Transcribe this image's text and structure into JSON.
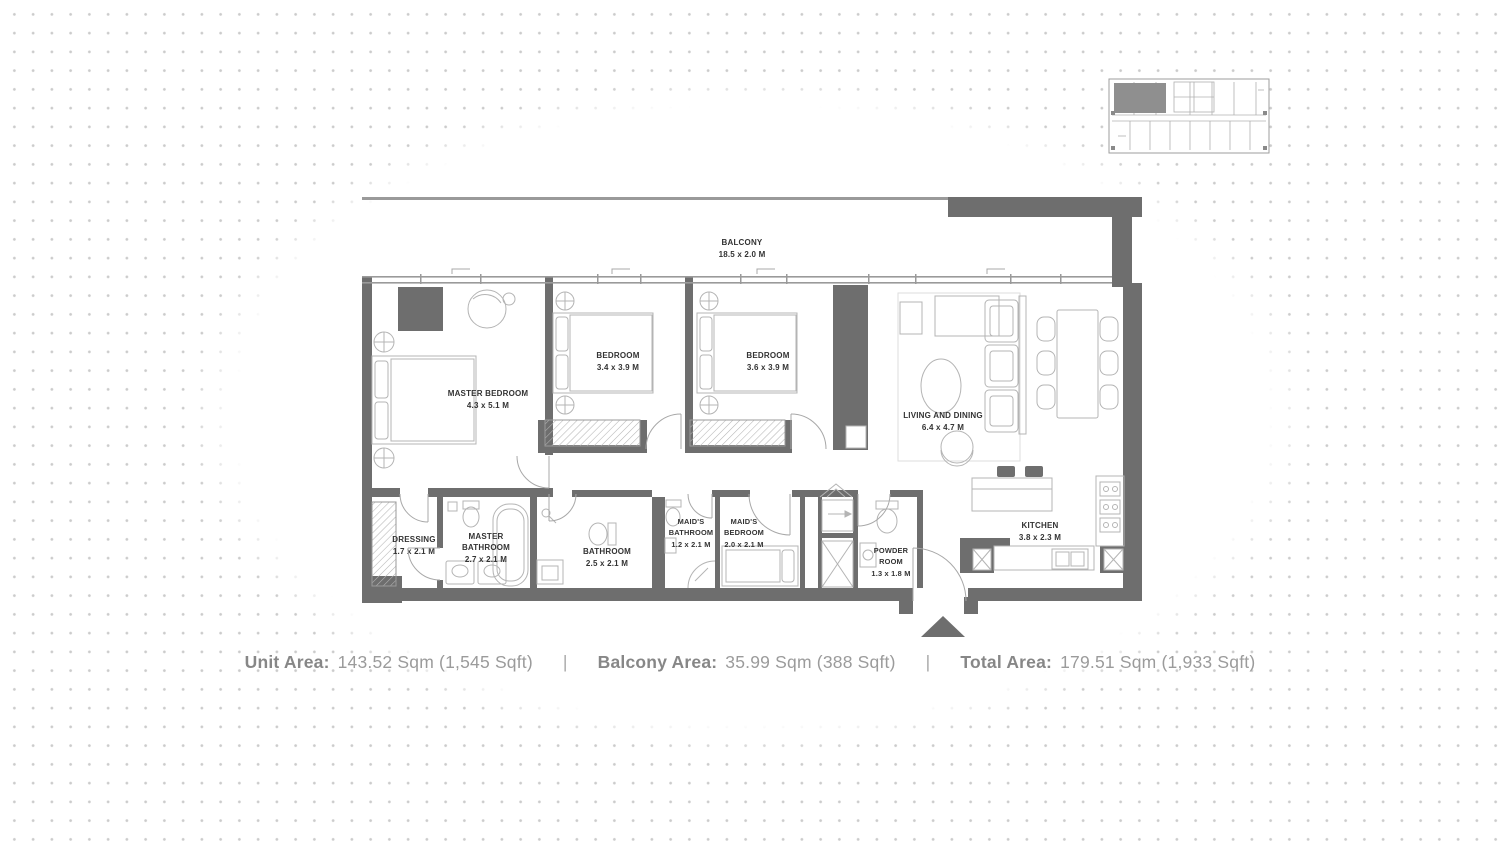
{
  "background": {
    "dot_color": "#cbcbcb"
  },
  "key_plan": {
    "highlight_color": "#8f8f8f"
  },
  "floor_plan": {
    "wall_color": "#6e6e6e",
    "furniture_line_color": "#b4b4b4",
    "label_color": "#333333",
    "rooms": [
      {
        "id": "balcony",
        "label_lines": [
          "BALCONY",
          "18.5 x 2.0 M"
        ]
      },
      {
        "id": "master-bedroom",
        "label_lines": [
          "MASTER BEDROOM",
          "4.3 x 5.1 M"
        ]
      },
      {
        "id": "bedroom-2",
        "label_lines": [
          "BEDROOM",
          "3.4 x 3.9 M"
        ]
      },
      {
        "id": "bedroom-3",
        "label_lines": [
          "BEDROOM",
          "3.6 x 3.9 M"
        ]
      },
      {
        "id": "living-dining",
        "label_lines": [
          "LIVING AND DINING",
          "6.4 x 4.7 M"
        ]
      },
      {
        "id": "kitchen",
        "label_lines": [
          "KITCHEN",
          "3.8 x 2.3 M"
        ]
      },
      {
        "id": "dressing",
        "label_lines": [
          "DRESSING",
          "1.7 x 2.1 M"
        ]
      },
      {
        "id": "master-bathroom",
        "label_lines": [
          "MASTER",
          "BATHROOM",
          "2.7 x 2.1 M"
        ]
      },
      {
        "id": "bathroom",
        "label_lines": [
          "BATHROOM",
          "2.5 x 2.1 M"
        ]
      },
      {
        "id": "maids-bathroom",
        "label_lines": [
          "MAID'S",
          "BATHROOM",
          "1.2 x 2.1 M"
        ]
      },
      {
        "id": "maids-bedroom",
        "label_lines": [
          "MAID'S",
          "BEDROOM",
          "2.0 x 2.1 M"
        ]
      },
      {
        "id": "powder-room",
        "label_lines": [
          "POWDER",
          "ROOM",
          "1.3 x 1.8 M"
        ]
      }
    ]
  },
  "footer": {
    "unit_area_label": "Unit Area:",
    "unit_area_value": "143.52 Sqm (1,545 Sqft)",
    "separator": "|",
    "balcony_area_label": "Balcony Area:",
    "balcony_area_value": "35.99 Sqm (388 Sqft)",
    "total_area_label": "Total Area:",
    "total_area_value": "179.51 Sqm (1,933 Sqft)"
  }
}
